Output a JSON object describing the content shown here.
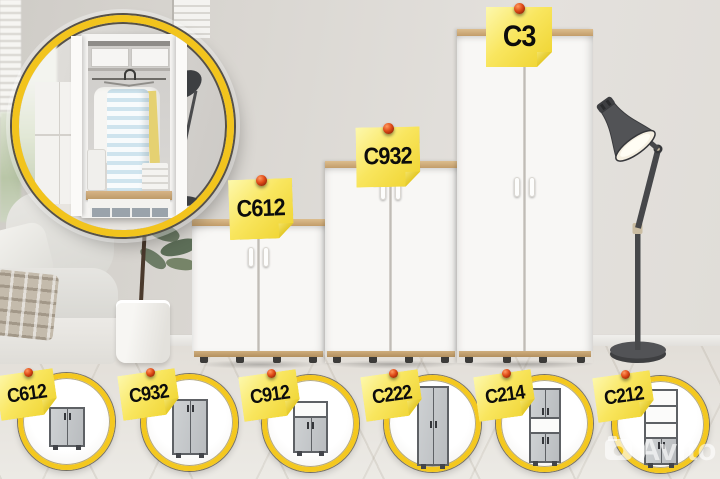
{
  "main_scene": {
    "notes": [
      {
        "label": "C612"
      },
      {
        "label": "C932"
      },
      {
        "label": "C3"
      }
    ]
  },
  "thumbnails": [
    {
      "label": "C612"
    },
    {
      "label": "C932"
    },
    {
      "label": "C912"
    },
    {
      "label": "C222"
    },
    {
      "label": "C214"
    },
    {
      "label": "C212"
    }
  ],
  "watermark": {
    "text": "Avito",
    "icon": "camera-icon"
  },
  "colors": {
    "accent_yellow": "#f4c81f",
    "note_yellow": "#f6df4a",
    "pin_red": "#d2430f",
    "wood_oak": "#c9a876",
    "cabinet_white": "#f8f7f5",
    "lamp_gray": "#4a4b4d",
    "wall": "#dcd9d4",
    "floor": "#e9e6e1"
  }
}
